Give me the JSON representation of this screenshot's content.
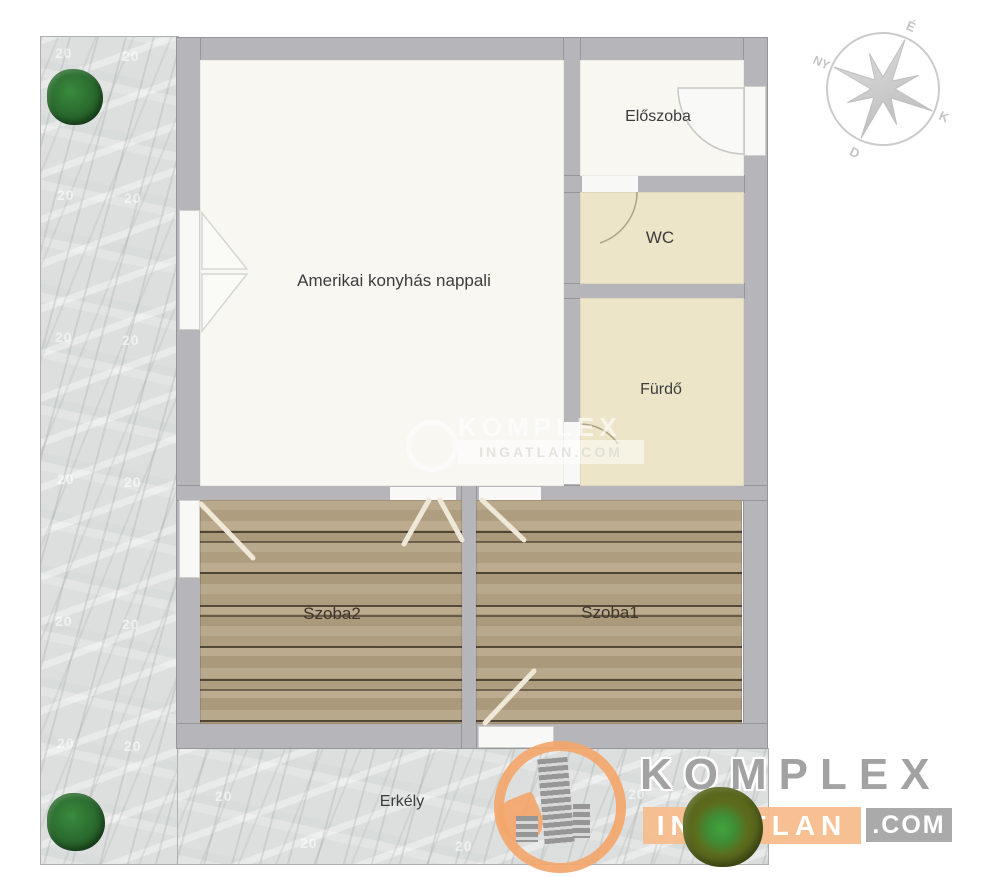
{
  "floorplan": {
    "rooms": [
      {
        "id": "living",
        "label": "Amerikai konyhás nappali"
      },
      {
        "id": "hall",
        "label": "Előszoba"
      },
      {
        "id": "wc",
        "label": "WC"
      },
      {
        "id": "bath",
        "label": "Fürdő"
      },
      {
        "id": "room2",
        "label": "Szoba2"
      },
      {
        "id": "room1",
        "label": "Szoba1"
      },
      {
        "id": "balcony",
        "label": "Erkély"
      }
    ],
    "ground_mark": "20"
  },
  "compass": {
    "n": "É",
    "e": "K",
    "s": "D",
    "w": "NY"
  },
  "watermark_center": {
    "brand": "KOMPLEX",
    "band": "INGATLAN.COM"
  },
  "logo": {
    "brand": "KOMPLEX",
    "band": "INGATLAN",
    "tld": ".COM"
  },
  "colors": {
    "wall": "#b6b5b9",
    "floor_light": "#f8f7f2",
    "floor_cream": "#ece5c8",
    "wood": "#b4a284",
    "ground": "#dcdfde",
    "logo_orange": "#f3a66a",
    "logo_gray": "#a5a5a5",
    "tree_green": "#2c6e30",
    "tree_olive": "#5d6b1e"
  }
}
